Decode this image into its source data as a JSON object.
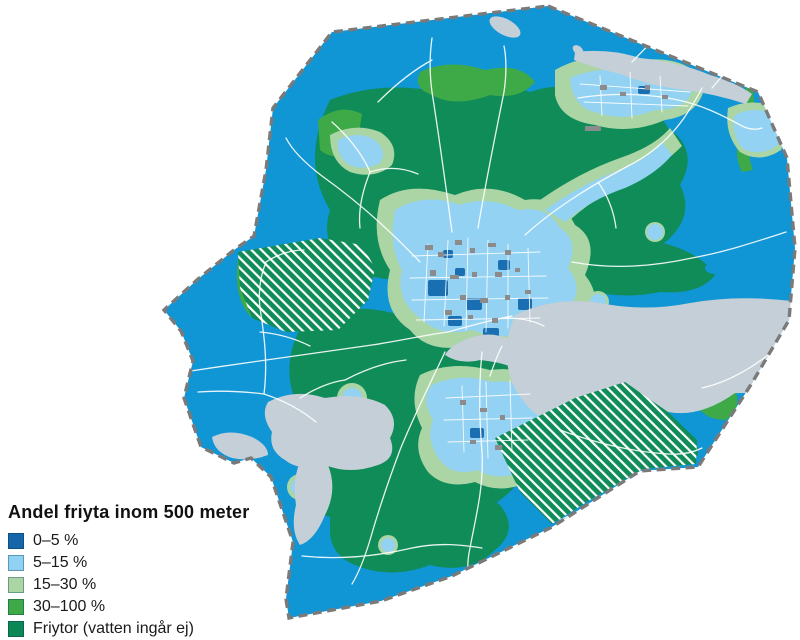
{
  "legend": {
    "title": "Andel friyta inom 500 meter",
    "items": [
      {
        "label": "0–5 %",
        "color": "#1566A9"
      },
      {
        "label": "5–15 %",
        "color": "#8FD2F3"
      },
      {
        "label": "15–30 %",
        "color": "#ABD5A5"
      },
      {
        "label": "30–100 %",
        "color": "#3EAA47"
      },
      {
        "label": "Friytor (vatten ingår ej)",
        "color": "#0E8756"
      }
    ]
  },
  "map": {
    "palette": {
      "base_blue": "#1095D5",
      "light_blue": "#93D2F2",
      "dark_blue": "#1A6FB2",
      "pale_green": "#ABD5A5",
      "mid_green": "#3EAA47",
      "dark_green": "#0F8C58",
      "water": "#C4CFD7",
      "road": "#FFFFFF",
      "building": "#8B8B8B",
      "boundary": "#7A7A7A",
      "hatch_stripe": "#FFFFFF"
    }
  }
}
